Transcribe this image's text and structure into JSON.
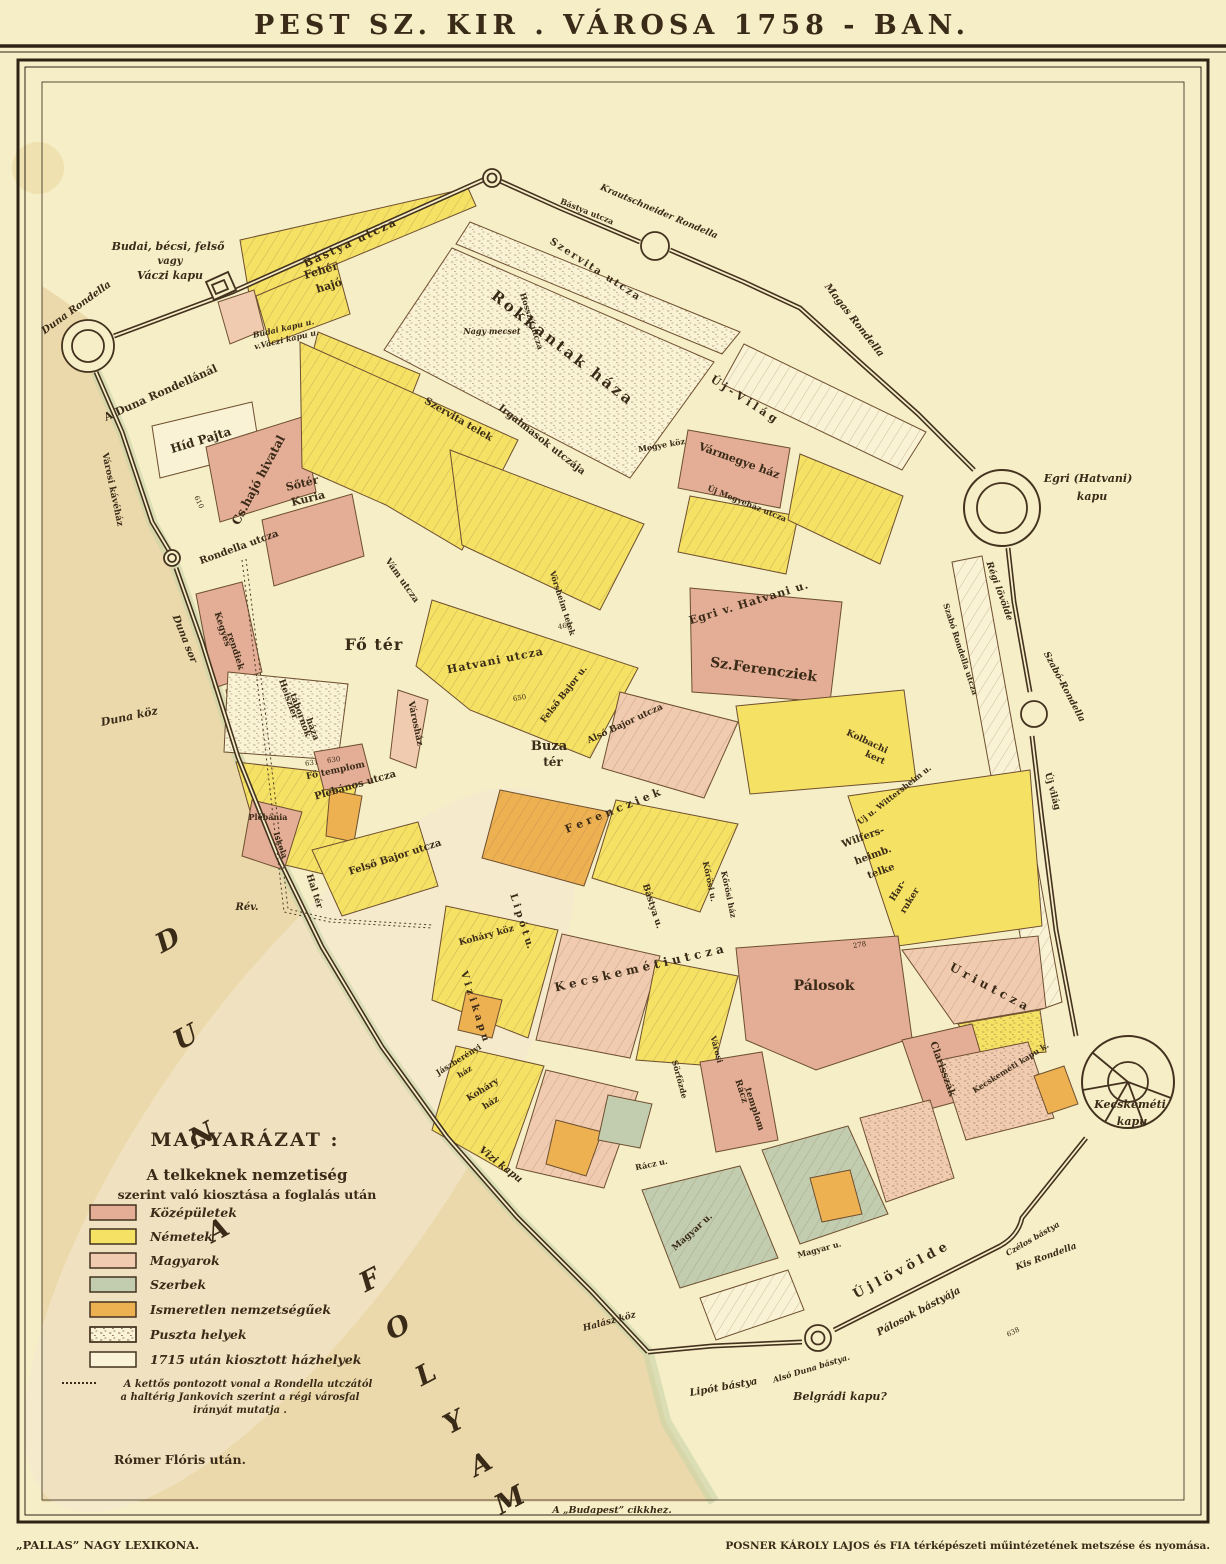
{
  "title": "PEST  SZ.  KIR . VÁROSA  1758 - BAN.",
  "bottom_note": "A „Budapest” cikkhez.",
  "attribution": "Rómer Flóris után.",
  "credits": {
    "left": "„PALLAS” NAGY LEXIKONA.",
    "right": "POSNER KÁROLY LAJOS és FIA térképészeti műintézetének metszése és nyomása."
  },
  "colors": {
    "paper": "#f6eec6",
    "paper_block": "#f9f2d4",
    "ink": "#3a2b18",
    "water": "#ecd9ab",
    "shore_green": "#c9d3a9",
    "wall": "#43321f",
    "block_stroke": "#6d4f30"
  },
  "legend": {
    "title": "MAGYARÁZAT :",
    "subtitle1": "A telkeknek nemzetiség",
    "subtitle2": "szerint való kiosztása a foglalás után",
    "items": [
      {
        "label": "Középületek",
        "color": "#e3ad96"
      },
      {
        "label": "Németek",
        "color": "#f5e163"
      },
      {
        "label": "Magyarok",
        "color": "#f1cbb0"
      },
      {
        "label": "Szerbek",
        "color": "#c2cdb0"
      },
      {
        "label": "Ismeretlen nemzetségűek",
        "color": "#eeb152"
      },
      {
        "label": "Puszta helyek",
        "color": "#faf3d8",
        "hatched": true
      },
      {
        "label": "1715 után kiosztott házhelyek",
        "color": "#faf3d8"
      }
    ],
    "note_lines": [
      "A kettős pontozott vonal a Rondella utczától",
      "a haltérig Jankovich szerint a régi városfal",
      "irányát mutatja ."
    ]
  },
  "map": {
    "labels": [
      {
        "t": "Budai, bécsi, felső",
        "x": 168,
        "y": 250,
        "s": 11,
        "i": 1,
        "b": 1
      },
      {
        "t": "vagy",
        "x": 170,
        "y": 264,
        "s": 10,
        "i": 1,
        "b": 1
      },
      {
        "t": "Váczi kapu",
        "x": 170,
        "y": 279,
        "s": 11,
        "i": 1,
        "b": 1
      },
      {
        "t": "Duna Rondella",
        "x": 78,
        "y": 310,
        "r": -36,
        "s": 10,
        "i": 1,
        "b": 1
      },
      {
        "t": "A Duna Rondellánál",
        "x": 162,
        "y": 396,
        "r": -24,
        "s": 11,
        "b": 1
      },
      {
        "t": "Városi kávéház",
        "x": 110,
        "y": 490,
        "r": 78,
        "s": 9,
        "b": 1
      },
      {
        "t": "Híd Pajta",
        "x": 202,
        "y": 444,
        "r": -17,
        "s": 12,
        "b": 1
      },
      {
        "t": "Cs.hajó hivatal",
        "x": 262,
        "y": 482,
        "r": -62,
        "s": 12,
        "b": 1
      },
      {
        "t": "Sőtér",
        "x": 303,
        "y": 487,
        "r": -14,
        "s": 11,
        "b": 1
      },
      {
        "t": "Kuria",
        "x": 309,
        "y": 502,
        "r": -14,
        "s": 11,
        "b": 1
      },
      {
        "t": "Budai kapu u.",
        "x": 284,
        "y": 331,
        "r": -13,
        "s": 8,
        "i": 1,
        "b": 1
      },
      {
        "t": "v.Váczi kapu u.",
        "x": 287,
        "y": 342,
        "r": -13,
        "s": 8,
        "i": 1,
        "b": 1
      },
      {
        "t": "Bástya utcza",
        "x": 352,
        "y": 246,
        "r": -25,
        "s": 11,
        "b": 1,
        "sp": 2
      },
      {
        "t": "Bástya utcza",
        "x": 586,
        "y": 214,
        "r": 22,
        "s": 8,
        "b": 1
      },
      {
        "t": "Krautschneider Rondella",
        "x": 658,
        "y": 214,
        "r": 23,
        "s": 9,
        "i": 1,
        "b": 1
      },
      {
        "t": "Szervita utcza",
        "x": 594,
        "y": 272,
        "r": 33,
        "s": 10,
        "b": 1,
        "sp": 2
      },
      {
        "t": "Fehér",
        "x": 322,
        "y": 274,
        "r": -17,
        "s": 11,
        "b": 1
      },
      {
        "t": "hajó",
        "x": 330,
        "y": 289,
        "r": -17,
        "s": 11,
        "b": 1
      },
      {
        "t": "Rokkantak háza",
        "x": 560,
        "y": 352,
        "r": 38,
        "s": 15,
        "b": 1,
        "sp": 3
      },
      {
        "t": "Nagy mecset",
        "x": 492,
        "y": 334,
        "s": 8,
        "i": 1,
        "b": 1
      },
      {
        "t": "Magas Rondella",
        "x": 852,
        "y": 322,
        "r": 52,
        "s": 10,
        "i": 1,
        "b": 1
      },
      {
        "t": "Ú j - V i l á g",
        "x": 742,
        "y": 402,
        "r": 33,
        "s": 11,
        "b": 1
      },
      {
        "t": "Szervita telek",
        "x": 457,
        "y": 422,
        "r": 30,
        "s": 10,
        "b": 1
      },
      {
        "t": "Irgalmasok utczája",
        "x": 540,
        "y": 442,
        "r": 38,
        "s": 10,
        "b": 1
      },
      {
        "t": "Megye köz",
        "x": 662,
        "y": 448,
        "r": -10,
        "s": 8,
        "b": 1
      },
      {
        "t": "Vármegye ház",
        "x": 738,
        "y": 464,
        "r": 20,
        "s": 11,
        "b": 1
      },
      {
        "t": "Új Megyeház utcza",
        "x": 746,
        "y": 506,
        "r": 22,
        "s": 8,
        "b": 1
      },
      {
        "t": "Egri (Hatvani)",
        "x": 1088,
        "y": 482,
        "s": 11,
        "i": 1,
        "b": 1
      },
      {
        "t": "kapu",
        "x": 1092,
        "y": 500,
        "s": 11,
        "i": 1,
        "b": 1
      },
      {
        "t": "Régi lövölde",
        "x": 997,
        "y": 592,
        "r": 70,
        "s": 9,
        "i": 1,
        "b": 1
      },
      {
        "t": "Szabó Rondella utcza",
        "x": 958,
        "y": 650,
        "r": 72,
        "s": 8,
        "b": 1
      },
      {
        "t": "Szabó-Rondella",
        "x": 1062,
        "y": 688,
        "r": 62,
        "s": 9,
        "i": 1,
        "b": 1
      },
      {
        "t": "Egri v. Hatvani u.",
        "x": 750,
        "y": 606,
        "r": -17,
        "s": 11,
        "b": 1,
        "sp": 1
      },
      {
        "t": "Sz.Ferencziek",
        "x": 763,
        "y": 674,
        "r": 8,
        "s": 14,
        "b": 1
      },
      {
        "t": "Kolbachi",
        "x": 866,
        "y": 744,
        "r": 25,
        "s": 9,
        "b": 1
      },
      {
        "t": "kert",
        "x": 874,
        "y": 760,
        "r": 25,
        "s": 9,
        "b": 1
      },
      {
        "t": "Fő tér",
        "x": 374,
        "y": 650,
        "s": 16,
        "b": 1,
        "sp": 1
      },
      {
        "t": "Hatvani utcza",
        "x": 496,
        "y": 664,
        "r": -11,
        "s": 11,
        "b": 1,
        "sp": 1
      },
      {
        "t": "Vörsheim telek",
        "x": 560,
        "y": 604,
        "r": 72,
        "s": 8,
        "b": 1
      },
      {
        "t": "Buza",
        "x": 549,
        "y": 750,
        "s": 13,
        "b": 1
      },
      {
        "t": "tér",
        "x": 553,
        "y": 766,
        "s": 12,
        "b": 1
      },
      {
        "t": "Felső Bajor u.",
        "x": 566,
        "y": 696,
        "r": -52,
        "s": 9,
        "b": 1
      },
      {
        "t": "Alsó Bajor utcza",
        "x": 626,
        "y": 726,
        "r": -25,
        "s": 9,
        "b": 1
      },
      {
        "t": "Plebános utcza",
        "x": 356,
        "y": 788,
        "r": -16,
        "s": 10,
        "b": 1
      },
      {
        "t": "Fő templom",
        "x": 336,
        "y": 773,
        "r": -12,
        "s": 9,
        "b": 1
      },
      {
        "t": "Plébánia",
        "x": 268,
        "y": 820,
        "s": 8,
        "b": 1
      },
      {
        "t": "Iskola",
        "x": 278,
        "y": 846,
        "r": 70,
        "s": 8,
        "b": 1
      },
      {
        "t": "Felső Bajor utcza",
        "x": 396,
        "y": 860,
        "r": -18,
        "s": 10,
        "b": 1
      },
      {
        "t": "Duna sor",
        "x": 182,
        "y": 640,
        "r": 68,
        "s": 10,
        "i": 1,
        "b": 1
      },
      {
        "t": "Duna köz",
        "x": 130,
        "y": 720,
        "r": -12,
        "s": 11,
        "i": 1,
        "b": 1
      },
      {
        "t": "Rondella utcza",
        "x": 240,
        "y": 550,
        "r": -20,
        "s": 10,
        "b": 1
      },
      {
        "t": "Kegyes",
        "x": 220,
        "y": 630,
        "r": 72,
        "s": 9,
        "b": 1
      },
      {
        "t": "rendiek",
        "x": 233,
        "y": 652,
        "r": 72,
        "s": 9,
        "b": 1
      },
      {
        "t": "Vám utcza",
        "x": 400,
        "y": 582,
        "r": 55,
        "s": 9,
        "b": 1
      },
      {
        "t": "Városház",
        "x": 413,
        "y": 724,
        "r": 78,
        "s": 9,
        "b": 1
      },
      {
        "t": "Heiszler",
        "x": 286,
        "y": 700,
        "r": 70,
        "s": 9,
        "b": 1
      },
      {
        "t": "tábornok",
        "x": 298,
        "y": 716,
        "r": 70,
        "s": 9,
        "b": 1
      },
      {
        "t": "háza",
        "x": 310,
        "y": 730,
        "r": 70,
        "s": 9,
        "b": 1
      },
      {
        "t": "Rév.",
        "x": 247,
        "y": 910,
        "s": 10,
        "i": 1,
        "b": 1
      },
      {
        "t": "Hal tér",
        "x": 312,
        "y": 892,
        "r": 72,
        "s": 9,
        "b": 1
      },
      {
        "t": "Koháry köz",
        "x": 487,
        "y": 938,
        "r": -15,
        "s": 9,
        "b": 1
      },
      {
        "t": "L i p ó t  u.",
        "x": 519,
        "y": 922,
        "r": 72,
        "s": 10,
        "b": 1
      },
      {
        "t": "K e c s k e m é t i   u t c z a",
        "x": 640,
        "y": 972,
        "r": -13,
        "s": 12,
        "b": 1
      },
      {
        "t": "V i z i  k a p u",
        "x": 472,
        "y": 1007,
        "r": 72,
        "s": 10,
        "b": 1
      },
      {
        "t": "Vizi kapu",
        "x": 499,
        "y": 1167,
        "r": 38,
        "s": 10,
        "i": 1,
        "b": 1
      },
      {
        "t": "F e r e n c z i e k",
        "x": 614,
        "y": 814,
        "r": -22,
        "s": 11,
        "b": 1
      },
      {
        "t": "Bástya u.",
        "x": 650,
        "y": 907,
        "r": 72,
        "s": 9,
        "b": 1
      },
      {
        "t": "Kőrösi u.",
        "x": 707,
        "y": 882,
        "r": 78,
        "s": 8,
        "b": 1
      },
      {
        "t": "Kőrösi ház",
        "x": 726,
        "y": 895,
        "r": 78,
        "s": 8,
        "b": 1
      },
      {
        "t": "U r i  u t c z a",
        "x": 987,
        "y": 990,
        "r": 28,
        "s": 12,
        "b": 1
      },
      {
        "t": "Wilfers-",
        "x": 864,
        "y": 840,
        "r": -20,
        "s": 10,
        "b": 1
      },
      {
        "t": "heimb.",
        "x": 874,
        "y": 858,
        "r": -20,
        "s": 10,
        "b": 1
      },
      {
        "t": "telke",
        "x": 882,
        "y": 874,
        "r": -20,
        "s": 10,
        "b": 1
      },
      {
        "t": "Har-",
        "x": 900,
        "y": 892,
        "r": -58,
        "s": 9,
        "b": 1
      },
      {
        "t": "ruker",
        "x": 912,
        "y": 902,
        "r": -58,
        "s": 9,
        "b": 1
      },
      {
        "t": "Uj u. Wittersheim u.",
        "x": 896,
        "y": 797,
        "r": -38,
        "s": 8,
        "b": 1
      },
      {
        "t": "Új világ",
        "x": 1050,
        "y": 792,
        "r": 75,
        "s": 9,
        "b": 1
      },
      {
        "t": "Hosszú utcza",
        "x": 529,
        "y": 322,
        "r": 72,
        "s": 8,
        "b": 1
      },
      {
        "t": "Pálosok",
        "x": 824,
        "y": 990,
        "s": 14,
        "b": 1
      },
      {
        "t": "Clarisszák",
        "x": 940,
        "y": 1070,
        "r": 70,
        "s": 10,
        "b": 1
      },
      {
        "t": "Rácz",
        "x": 739,
        "y": 1092,
        "r": 72,
        "s": 9,
        "b": 1
      },
      {
        "t": "templom",
        "x": 752,
        "y": 1110,
        "r": 72,
        "s": 9,
        "b": 1
      },
      {
        "t": "Városi",
        "x": 714,
        "y": 1050,
        "r": 75,
        "s": 8,
        "b": 1
      },
      {
        "t": "Sörfőzde",
        "x": 677,
        "y": 1080,
        "r": 75,
        "s": 8,
        "b": 1
      },
      {
        "t": "Rácz u.",
        "x": 652,
        "y": 1167,
        "r": -12,
        "s": 8,
        "b": 1
      },
      {
        "t": "Magyar u.",
        "x": 694,
        "y": 1234,
        "r": -42,
        "s": 9,
        "b": 1
      },
      {
        "t": "Magyar u.",
        "x": 820,
        "y": 1252,
        "r": -15,
        "s": 8,
        "b": 1
      },
      {
        "t": "Halász köz",
        "x": 610,
        "y": 1324,
        "r": -15,
        "s": 9,
        "i": 1,
        "b": 1
      },
      {
        "t": "Jászberényi",
        "x": 460,
        "y": 1062,
        "r": -32,
        "s": 8,
        "b": 1
      },
      {
        "t": "ház",
        "x": 466,
        "y": 1074,
        "r": -32,
        "s": 8,
        "b": 1
      },
      {
        "t": "Koháry",
        "x": 484,
        "y": 1092,
        "r": -32,
        "s": 9,
        "b": 1
      },
      {
        "t": "ház",
        "x": 492,
        "y": 1105,
        "r": -32,
        "s": 9,
        "b": 1
      },
      {
        "t": "Lipót bástya",
        "x": 724,
        "y": 1390,
        "r": -10,
        "s": 10,
        "i": 1,
        "b": 1
      },
      {
        "t": "Alsó Duna bástya.",
        "x": 812,
        "y": 1371,
        "r": -17,
        "s": 8,
        "i": 1,
        "b": 1
      },
      {
        "t": "Belgrádi kapu?",
        "x": 840,
        "y": 1400,
        "s": 11,
        "i": 1,
        "b": 1
      },
      {
        "t": "Ú j  l ö v ö l d e",
        "x": 902,
        "y": 1274,
        "r": -28,
        "s": 13,
        "b": 1
      },
      {
        "t": "Pálosok bástyája",
        "x": 920,
        "y": 1314,
        "r": -28,
        "s": 10,
        "i": 1,
        "b": 1
      },
      {
        "t": "Czélos bástya",
        "x": 1034,
        "y": 1241,
        "r": -30,
        "s": 8,
        "i": 1,
        "b": 1
      },
      {
        "t": "Kis Rondella",
        "x": 1047,
        "y": 1259,
        "r": -20,
        "s": 9,
        "i": 1,
        "b": 1
      },
      {
        "t": "Kecskeméti",
        "x": 1130,
        "y": 1108,
        "s": 11,
        "i": 1,
        "b": 1
      },
      {
        "t": "kapu",
        "x": 1132,
        "y": 1125,
        "s": 11,
        "i": 1,
        "b": 1
      },
      {
        "t": "Kecskeméti kapu k.",
        "x": 1012,
        "y": 1070,
        "r": -32,
        "s": 8,
        "b": 1
      },
      {
        "t": "D",
        "x": 172,
        "y": 948,
        "r": -28,
        "s": 27,
        "i": 1,
        "b": 1
      },
      {
        "t": "U",
        "x": 190,
        "y": 1045,
        "r": -28,
        "s": 27,
        "i": 1,
        "b": 1
      },
      {
        "t": "N",
        "x": 206,
        "y": 1143,
        "r": -28,
        "s": 27,
        "i": 1,
        "b": 1
      },
      {
        "t": "A",
        "x": 222,
        "y": 1238,
        "r": -28,
        "s": 27,
        "i": 1,
        "b": 1
      },
      {
        "t": "F",
        "x": 374,
        "y": 1288,
        "r": -28,
        "s": 27,
        "i": 1,
        "b": 1
      },
      {
        "t": "O",
        "x": 402,
        "y": 1335,
        "r": -28,
        "s": 27,
        "i": 1,
        "b": 1
      },
      {
        "t": "L",
        "x": 430,
        "y": 1382,
        "r": -28,
        "s": 27,
        "i": 1,
        "b": 1
      },
      {
        "t": "Y",
        "x": 458,
        "y": 1430,
        "r": -28,
        "s": 27,
        "i": 1,
        "b": 1
      },
      {
        "t": "A",
        "x": 485,
        "y": 1472,
        "r": -28,
        "s": 27,
        "i": 1,
        "b": 1
      },
      {
        "t": "M",
        "x": 514,
        "y": 1508,
        "r": -28,
        "s": 27,
        "i": 1,
        "b": 1
      }
    ],
    "parcel_numbers_sample": [
      {
        "t": "610",
        "x": 197,
        "y": 503,
        "r": 65
      },
      {
        "t": "278",
        "x": 860,
        "y": 947,
        "r": -10
      },
      {
        "t": "631",
        "x": 312,
        "y": 765,
        "r": -8
      },
      {
        "t": "630",
        "x": 334,
        "y": 762,
        "r": -8
      },
      {
        "t": "638",
        "x": 1014,
        "y": 1334,
        "r": -25
      },
      {
        "t": "460",
        "x": 565,
        "y": 628,
        "r": -10
      },
      {
        "t": "650",
        "x": 520,
        "y": 700,
        "r": -10
      }
    ]
  }
}
